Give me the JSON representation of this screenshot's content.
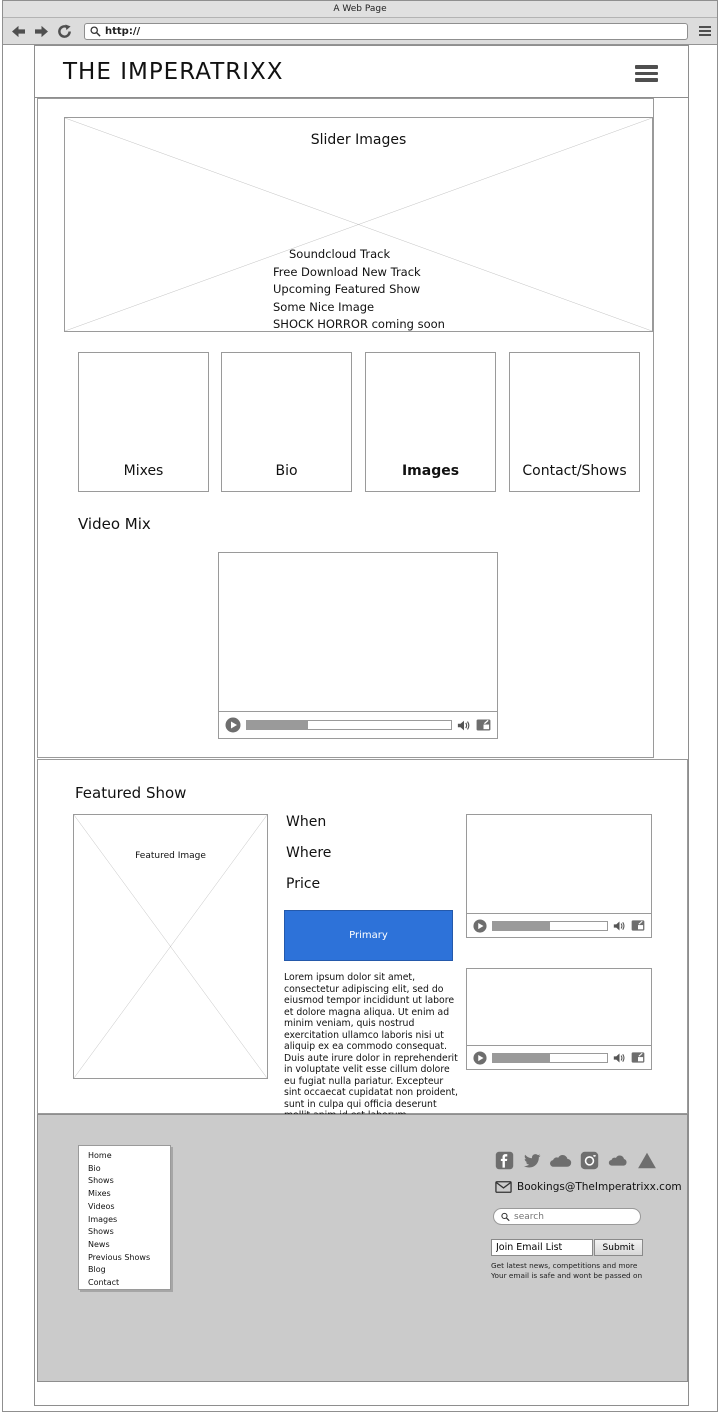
{
  "browser": {
    "window_title": "A Web Page",
    "url": "http://"
  },
  "header": {
    "site_title": "THE IMPERATRIXX"
  },
  "slider": {
    "title": "Slider Images",
    "items": [
      "Soundcloud Track",
      "Free Download New Track",
      "Upcoming Featured Show",
      "Some Nice Image",
      "SHOCK HORROR coming soon"
    ]
  },
  "nav_cards": [
    "Mixes",
    "Bio",
    "Images",
    "Contact/Shows"
  ],
  "video_mix": {
    "heading": "Video Mix"
  },
  "featured_show": {
    "heading": "Featured Show",
    "image_label": "Featured Image",
    "fields": [
      "When",
      "Where",
      "Price"
    ],
    "button_label": "Primary",
    "description": "Lorem ipsum dolor sit amet, consectetur adipiscing elit, sed do eiusmod tempor incididunt ut labore et dolore magna aliqua. Ut enim ad minim veniam, quis nostrud exercitation ullamco laboris nisi ut aliquip ex ea commodo consequat. Duis aute irure dolor in reprehenderit in voluptate velit esse cillum dolore eu fugiat nulla pariatur. Excepteur sint occaecat cupidatat non proident, sunt in culpa qui officia deserunt mollit anim id est laborum"
  },
  "footer": {
    "nav_items": [
      "Home",
      "Bio",
      "Shows",
      "Mixes",
      "Videos",
      "Images",
      "Shows",
      "News",
      "Previous Shows",
      "Blog",
      "Contact"
    ],
    "social_icons": [
      "facebook-icon",
      "twitter-icon",
      "soundcloud-icon",
      "instagram-icon",
      "mixcloud-icon",
      "triangle-icon"
    ],
    "email": "Bookings@TheImperatrixx.com",
    "search_placeholder": "search",
    "email_signup": {
      "value": "Join Email List",
      "submit_label": "Submit",
      "note_line1": "Get latest news, competitions and more",
      "note_line2": "Your email is safe and wont be passed on"
    }
  },
  "colors": {
    "primary_button": "#2D72D9",
    "footer_background": "#CBCBCB",
    "chrome_background": "#DCDCDC"
  }
}
